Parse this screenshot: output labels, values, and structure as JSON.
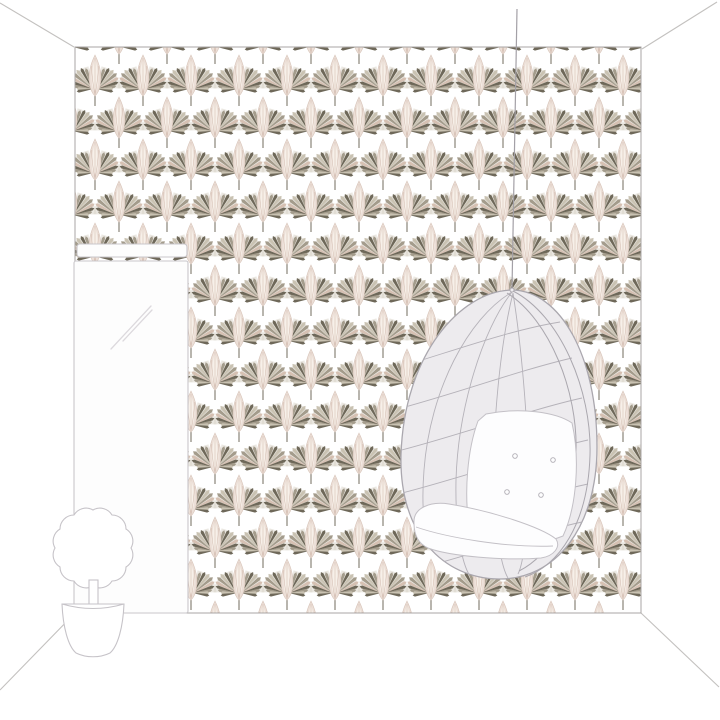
{
  "scene": {
    "kind": "interior-room-wallpaper-mockup-illustration",
    "description": "Line-art room preview showing a feature wall covered in an Art Deco fan-palm wallpaper, a hanging egg chair suspended on a cord, a tall mirror leaning on the left wall and a potted topiary plant on the floor.",
    "elements": [
      "room-outline",
      "wallpaper-wall",
      "mirror",
      "hanging-cord",
      "hanging-egg-chair",
      "potted-plant"
    ]
  },
  "wallpaper": {
    "motif": "art-deco-fan-palm",
    "repeat": {
      "tile_width_px": 48,
      "row_height_px": 42,
      "half_drop_offset_px": 24
    }
  },
  "colors": {
    "page_bg": "#ffffff",
    "room_line": "#c3c1bf",
    "wall_line": "#a9a6a4",
    "wallpaper_bg": "#ffffff",
    "fan_dark": "#6e6859",
    "fan_mid": "#a49c8c",
    "fan_light": "#c9c2b2",
    "fan_pink": "#d5c0b2",
    "fan_bg": "#d8d2c6",
    "plume_fill": "#ecdfd7",
    "plume_inner": "#f7f0e9",
    "plume_edge": "#d8c5ba",
    "plume_streak": "#d3bcb0",
    "stem": "#8a8478",
    "cord": "#a3a0a6",
    "chair_fill": "#edebee",
    "chair_line": "#aaa7ae",
    "chair_grid": "#b5b2b9",
    "cushion_fill": "#fdfdfe",
    "cushion_line": "#c3c0c6",
    "button_line": "#b0adb4",
    "mirror_fill": "#fdfdfd",
    "mirror_line": "#c9c6ca",
    "mirror_reflect": "#dcd9dd",
    "plant_fill": "#ffffff",
    "plant_line": "#c6c3c8"
  }
}
